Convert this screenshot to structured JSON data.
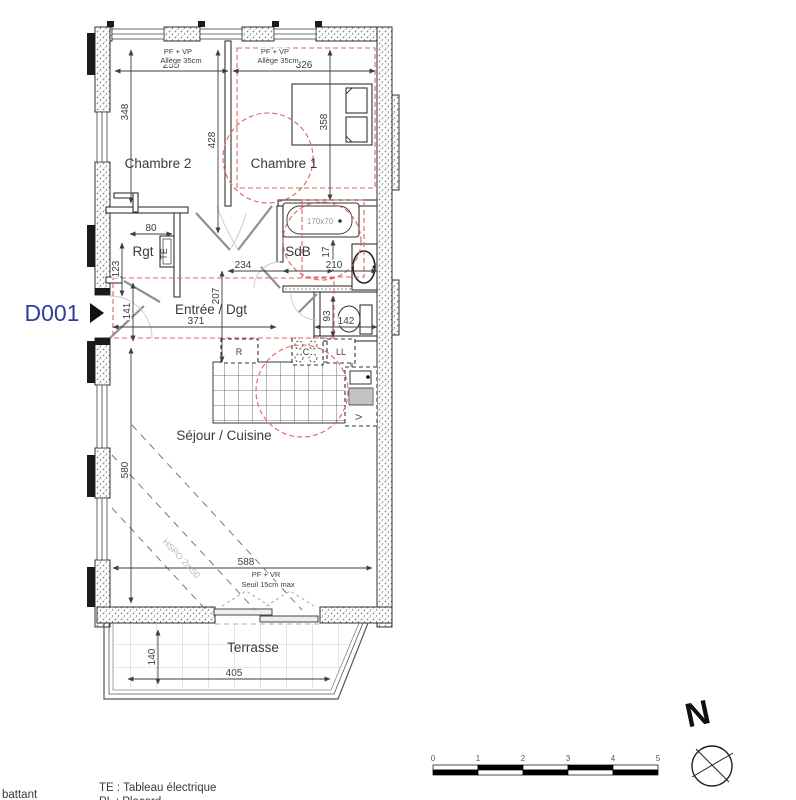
{
  "unit": {
    "label": "D001"
  },
  "rooms": {
    "chambre2": "Chambre 2",
    "chambre1": "Chambre 1",
    "rgt": "Rgt",
    "sdb": "SdB",
    "entree": "Entrée / Dgt",
    "sejour": "Séjour / Cuisine",
    "terrasse": "Terrasse"
  },
  "openings": {
    "window_ch2_line1": "PF + VP",
    "window_ch2_line2": "Allège 35cm",
    "window_ch1_line1": "PF + VP",
    "window_ch1_line2": "Allège 35cm",
    "bay_line1": "PF + VR",
    "bay_line2": "Seuil 15cm max"
  },
  "fixtures": {
    "bathtub_size": "170x70",
    "te": "TE",
    "fridge": "R",
    "hob": "C",
    "washer": "LL",
    "vmc": "V",
    "ceiling_note": "HSPO 2m50"
  },
  "dimensions": {
    "ch2_width": "255",
    "ch1_width": "326",
    "ch2_height": "348",
    "mid_height": "428",
    "ch1_height": "358",
    "rgt_width": "80",
    "rgt_height": "123",
    "hall_width": "234",
    "sdb_width": "210",
    "sdb_offset": "17",
    "hall_height": "207",
    "entry_height": "141",
    "entry_width": "371",
    "wc_width": "142",
    "wc_height": "93",
    "sejour_height": "580",
    "sejour_width": "588",
    "terrasse_depth": "140",
    "terrasse_width": "405"
  },
  "legend": {
    "te": "TE : Tableau électrique",
    "pl": "PL : Placard",
    "battant": "battant"
  },
  "scalebar": {
    "ticks": [
      "0",
      "1",
      "2",
      "3",
      "4",
      "5"
    ]
  },
  "compass": {
    "label": "N"
  }
}
